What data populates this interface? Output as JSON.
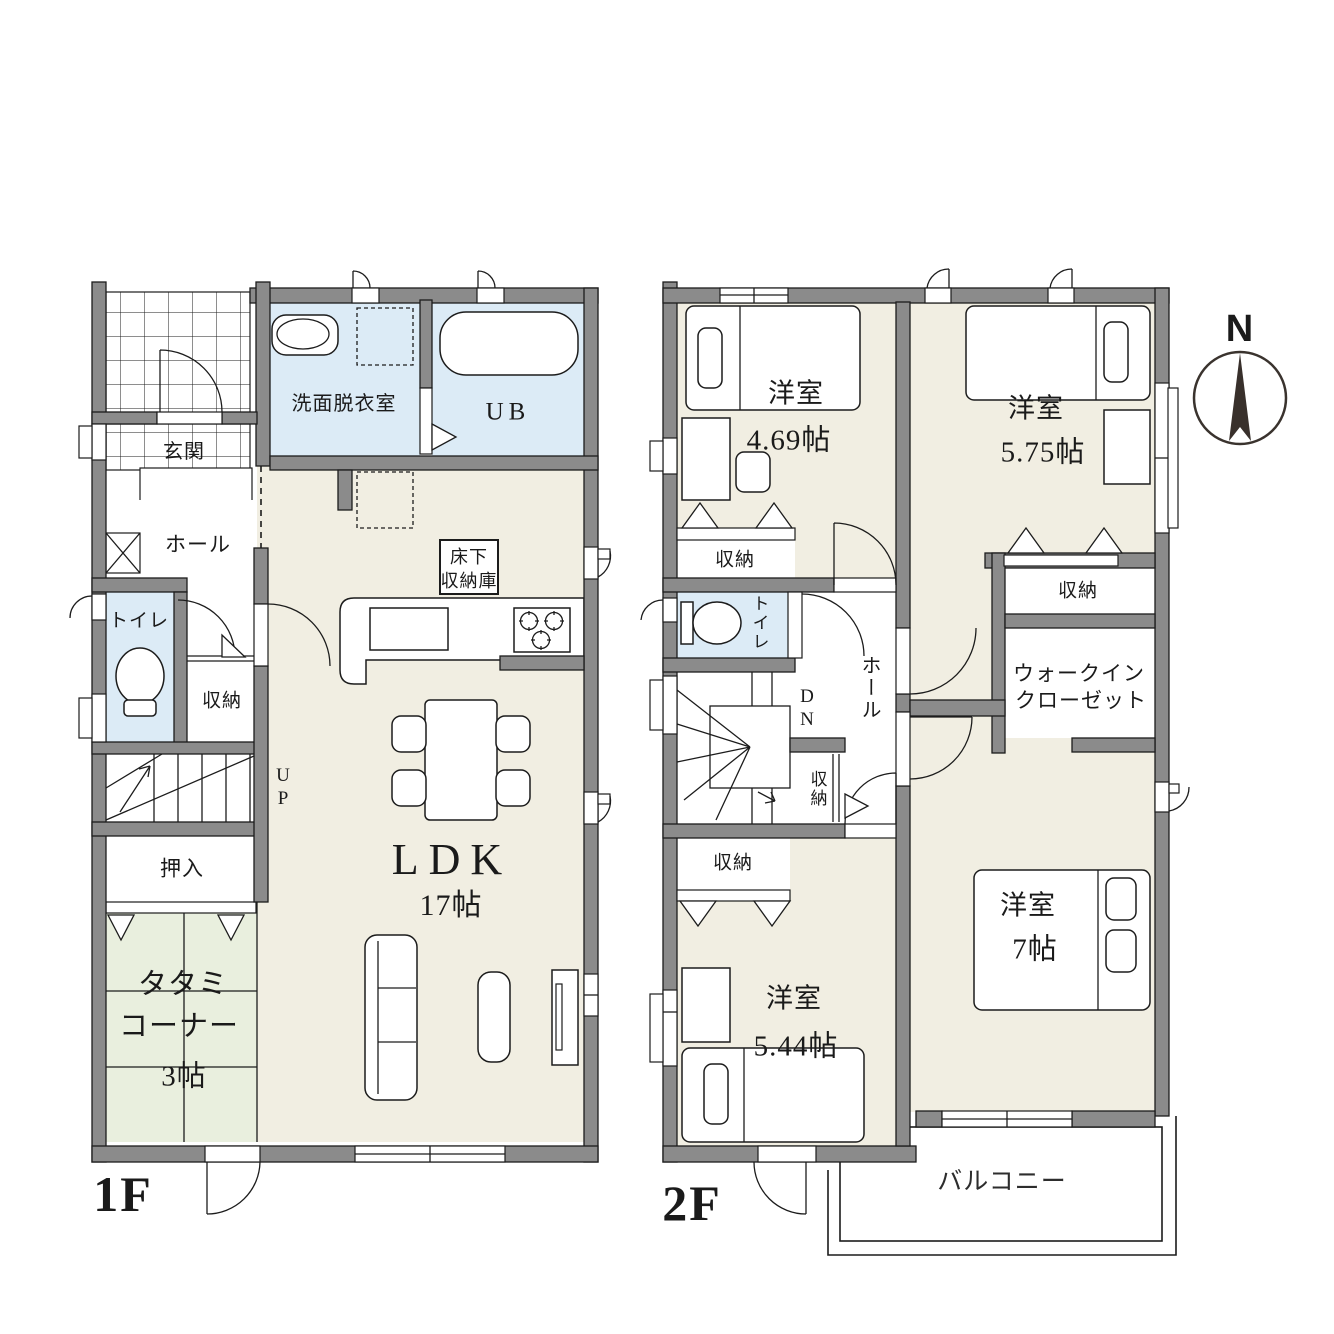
{
  "meta": {
    "type": "floor-plan",
    "floors_shown": 2
  },
  "colors": {
    "wall": "#8b8b8b",
    "room_floor": "#f1eee2",
    "wet_area": "#dcebf6",
    "tatami": "#e9efde",
    "background": "#ffffff"
  },
  "floor1": {
    "title": "1F",
    "rooms": {
      "genkan": "玄関",
      "hall": "ホール",
      "toilet": "トイレ",
      "storage": "収納",
      "washroom": "洗面脱衣室",
      "bath": "UB",
      "underfloor_line1": "床下",
      "underfloor_line2": "収納庫",
      "ldk": "LDK",
      "ldk_size": "17帖",
      "stairs_up": "UP",
      "oshiire": "押入",
      "tatami_line1": "タタミ",
      "tatami_line2": "コーナー",
      "tatami_size": "3帖"
    }
  },
  "floor2": {
    "title": "2F",
    "rooms": {
      "room1": "洋室",
      "room1_size": "4.69帖",
      "room2": "洋室",
      "room2_size": "5.75帖",
      "room3": "洋室",
      "room3_size": "7帖",
      "room4": "洋室",
      "room4_size": "5.44帖",
      "closet_room1": "収納",
      "closet_room2": "収納",
      "closet_stairs": "収納",
      "closet_room4": "収納",
      "toilet": "トイレ",
      "hall": "ホール",
      "stairs_down": "DN",
      "wic_line1": "ウォークイン",
      "wic_line2": "クローゼット",
      "balcony": "バルコニー"
    }
  },
  "compass": {
    "north": "N"
  }
}
